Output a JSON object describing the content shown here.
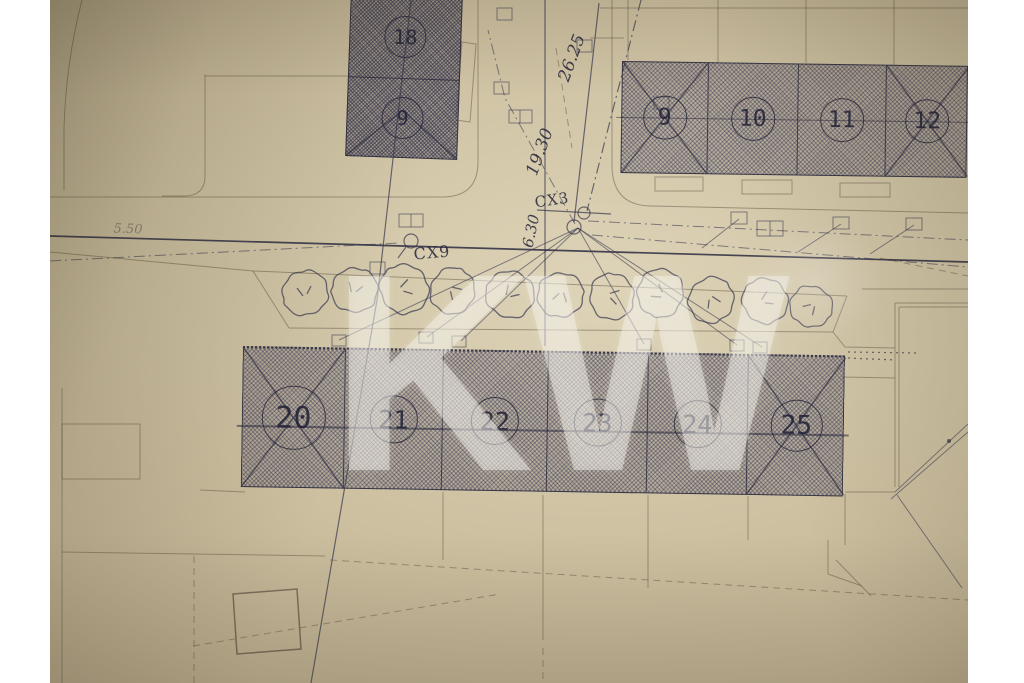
{
  "document": {
    "type": "scanned architectural site plan photograph",
    "watermark_text": "KW"
  },
  "plan": {
    "north_left_block": {
      "units": [
        {
          "number": "18"
        },
        {
          "number": "9"
        }
      ]
    },
    "north_right_block": {
      "units": [
        {
          "number": "9"
        },
        {
          "number": "10"
        },
        {
          "number": "11"
        },
        {
          "number": "12"
        }
      ]
    },
    "south_block": {
      "units": [
        {
          "number": "20"
        },
        {
          "number": "21"
        },
        {
          "number": "22"
        },
        {
          "number": "23"
        },
        {
          "number": "24"
        },
        {
          "number": "25"
        }
      ]
    },
    "annotations": {
      "dim_road_upper": "26.25",
      "dim_road_lower": "19.30",
      "dim_junction": "6.30",
      "manhole_upper": "CX3",
      "manhole_lower": "CX9",
      "dim_left_faint": "5.50"
    },
    "tree_count": 11
  },
  "colors": {
    "background": "#ffffff",
    "paper": "#cdbf9f",
    "ink": "#32324a",
    "watermark": "rgba(247,244,236,0.44)"
  }
}
